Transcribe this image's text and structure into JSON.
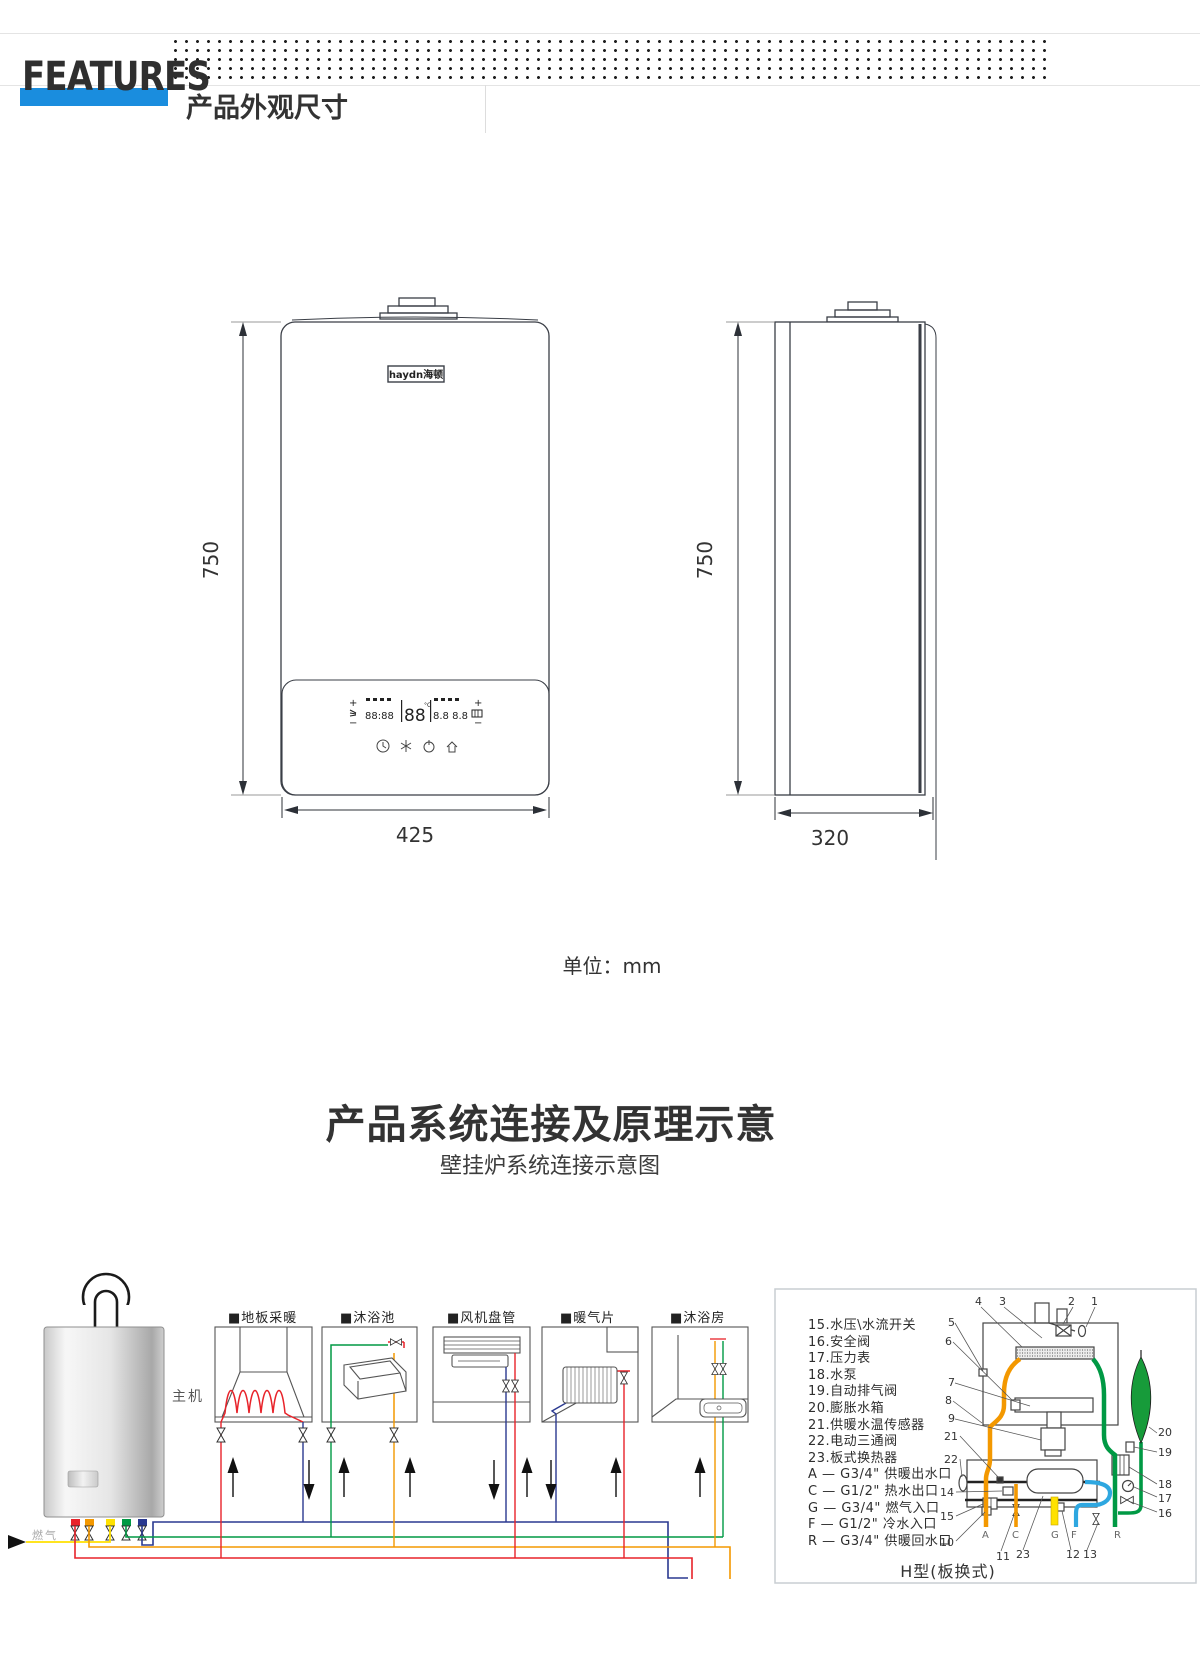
{
  "header": {
    "features_label": "FEATURES",
    "section1_title": "产品外观尺寸",
    "accent_color": "#1a8dde"
  },
  "dimensions": {
    "front_height": "750",
    "front_width": "425",
    "side_height": "750",
    "side_depth": "320",
    "unit_note": "单位：mm",
    "logo": "haydn海顿"
  },
  "lcd": {
    "left_plus": "+",
    "left_minus": "−",
    "right_plus": "+",
    "right_minus": "−",
    "seg_left": "88:88",
    "seg_mid": "88",
    "seg_unit": "°C",
    "seg_right": "8.8 8.8"
  },
  "section2": {
    "title": "产品系统连接及原理示意",
    "subtitle": "壁挂炉系统连接示意图"
  },
  "diagram": {
    "main_unit_label": "主机",
    "gas_label": "燃气",
    "rooms": [
      "■地板采暖",
      "■沐浴池",
      "■风机盘管",
      "■暖气片",
      "■沐浴房"
    ],
    "colors": {
      "supply_red": "#e8232a",
      "return_navy": "#2a3990",
      "heating_green": "#009944",
      "hot_orange": "#f39800",
      "gas_yellow": "#ffe100",
      "cold_blue": "#2ea7e0"
    },
    "panel": {
      "caption": "H型(板换式)",
      "parts": [
        "15.水压\\水流开关",
        "16.安全阀",
        "17.压力表",
        "18.水泵",
        "19.自动排气阀",
        "20.膨胀水箱",
        "21.供暖水温传感器",
        "22.电动三通阀",
        "23.板式换热器",
        "A — G3/4\" 供暖出水口",
        "C — G1/2\" 热水出口",
        "G — G3/4\" 燃气入口",
        "F — G1/2\" 冷水入口",
        "R — G3/4\" 供暖回水口"
      ],
      "callouts": [
        {
          "x": 975,
          "y": 110,
          "t": "4"
        },
        {
          "x": 999,
          "y": 110,
          "t": "3"
        },
        {
          "x": 1068,
          "y": 110,
          "t": "2"
        },
        {
          "x": 1091,
          "y": 110,
          "t": "1"
        },
        {
          "x": 948,
          "y": 131,
          "t": "5"
        },
        {
          "x": 945,
          "y": 150,
          "t": "6"
        },
        {
          "x": 948,
          "y": 191,
          "t": "7"
        },
        {
          "x": 945,
          "y": 209,
          "t": "8"
        },
        {
          "x": 948,
          "y": 227,
          "t": "9"
        },
        {
          "x": 944,
          "y": 245,
          "t": "21"
        },
        {
          "x": 944,
          "y": 268,
          "t": "22"
        },
        {
          "x": 940,
          "y": 301,
          "t": "14"
        },
        {
          "x": 940,
          "y": 325,
          "t": "15"
        },
        {
          "x": 940,
          "y": 351,
          "t": "10"
        },
        {
          "x": 1158,
          "y": 241,
          "t": "20"
        },
        {
          "x": 1158,
          "y": 261,
          "t": "19"
        },
        {
          "x": 1158,
          "y": 293,
          "t": "18"
        },
        {
          "x": 1158,
          "y": 307,
          "t": "17"
        },
        {
          "x": 1158,
          "y": 322,
          "t": "16"
        },
        {
          "x": 996,
          "y": 365,
          "t": "11"
        },
        {
          "x": 1016,
          "y": 363,
          "t": "23"
        },
        {
          "x": 1066,
          "y": 363,
          "t": "12"
        },
        {
          "x": 1083,
          "y": 363,
          "t": "13"
        }
      ],
      "ports": [
        {
          "x": 982,
          "y": 343,
          "t": "A"
        },
        {
          "x": 1012,
          "y": 343,
          "t": "C"
        },
        {
          "x": 1051,
          "y": 343,
          "t": "G"
        },
        {
          "x": 1071,
          "y": 343,
          "t": "F"
        },
        {
          "x": 1114,
          "y": 343,
          "t": "R"
        }
      ]
    }
  }
}
